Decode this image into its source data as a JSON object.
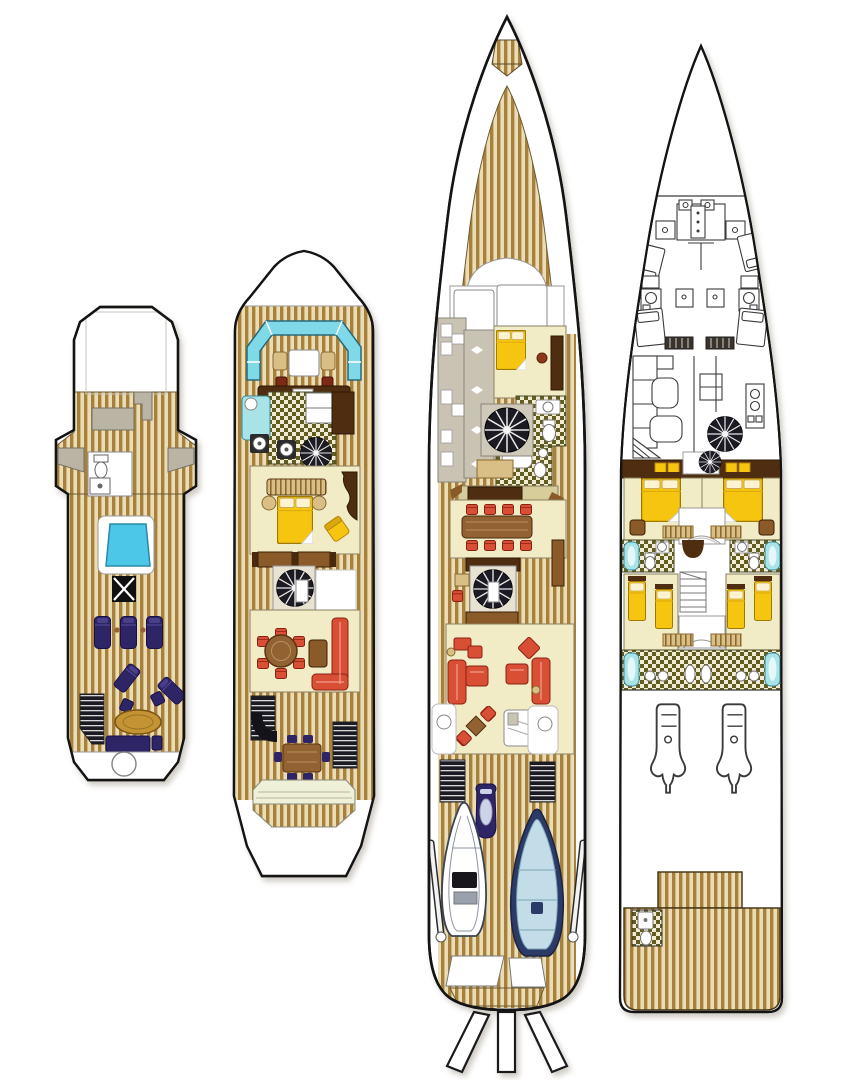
{
  "page": {
    "background": "#ffffff"
  },
  "palette": {
    "hull-outline": "#141414",
    "line-gray": "#707070",
    "white": "#ffffff",
    "teak-light": "#ecdcb4",
    "teak-dark": "#a6813e",
    "cream": "#f1ecc6",
    "pale-platform": "#eef0d8",
    "gray-pad": "#b9b4a4",
    "gray-cabinet": "#c9c3b4",
    "pool-blue": "#4cc7e8",
    "settee-cyan": "#7fd9e8",
    "tub-cyan": "#a8e3e8",
    "navy": "#2e2566",
    "gold": "#f6c50f",
    "tan": "#d9bf85",
    "red": "#d94f35",
    "brown-dark": "#4f2d10",
    "brown-mid": "#8a5a28",
    "wood-table": "#926232",
    "check-dark": "#615d20",
    "check-light": "#f2ecd4",
    "stair-dark": "#1c1a22",
    "rib-navy": "#2b3a66",
    "rib-interior": "#c2dde8",
    "khaki": "#d6cd9a"
  },
  "diagram": {
    "type": "yacht-deck-plan",
    "deck_count": 4,
    "decks": [
      {
        "id": "sun-deck",
        "features": [
          "mast-housing",
          "wing-consoles",
          "wc-compartment",
          "jacuzzi",
          "skylight-hatch",
          "sun-loungers",
          "cocktail-table",
          "bench-seat",
          "stairway",
          "stern-platform"
        ]
      },
      {
        "id": "bridge-deck",
        "features": [
          "bow-settee",
          "settee-table",
          "helm-console",
          "galley",
          "sink-counter",
          "stove-burners",
          "spiral-staircase",
          "lounge-sofa",
          "double-bed",
          "armchair",
          "round-dining-table",
          "sideboard",
          "l-sofa",
          "aft-stairways",
          "aft-table",
          "swim-platform"
        ]
      },
      {
        "id": "main-deck",
        "features": [
          "bow-platform",
          "foredeck",
          "wheelhouse",
          "galley",
          "captain-cabin",
          "bathrooms",
          "spiral-staircases",
          "dining-table",
          "dining-chairs",
          "salon-sofas",
          "card-table",
          "bar",
          "side-tables",
          "aft-stairways",
          "jet-ski",
          "tender",
          "rib-tender",
          "davits",
          "stern-hatches",
          "passerelle"
        ]
      },
      {
        "id": "lower-deck",
        "features": [
          "forepeak",
          "crew-cabins",
          "crew-bathrooms",
          "crew-mess",
          "laundry",
          "spiral-staircase",
          "guest-double-cabins",
          "guest-twin-cabins",
          "guest-bathrooms",
          "engine-room",
          "day-head",
          "stern-platform"
        ]
      }
    ]
  }
}
